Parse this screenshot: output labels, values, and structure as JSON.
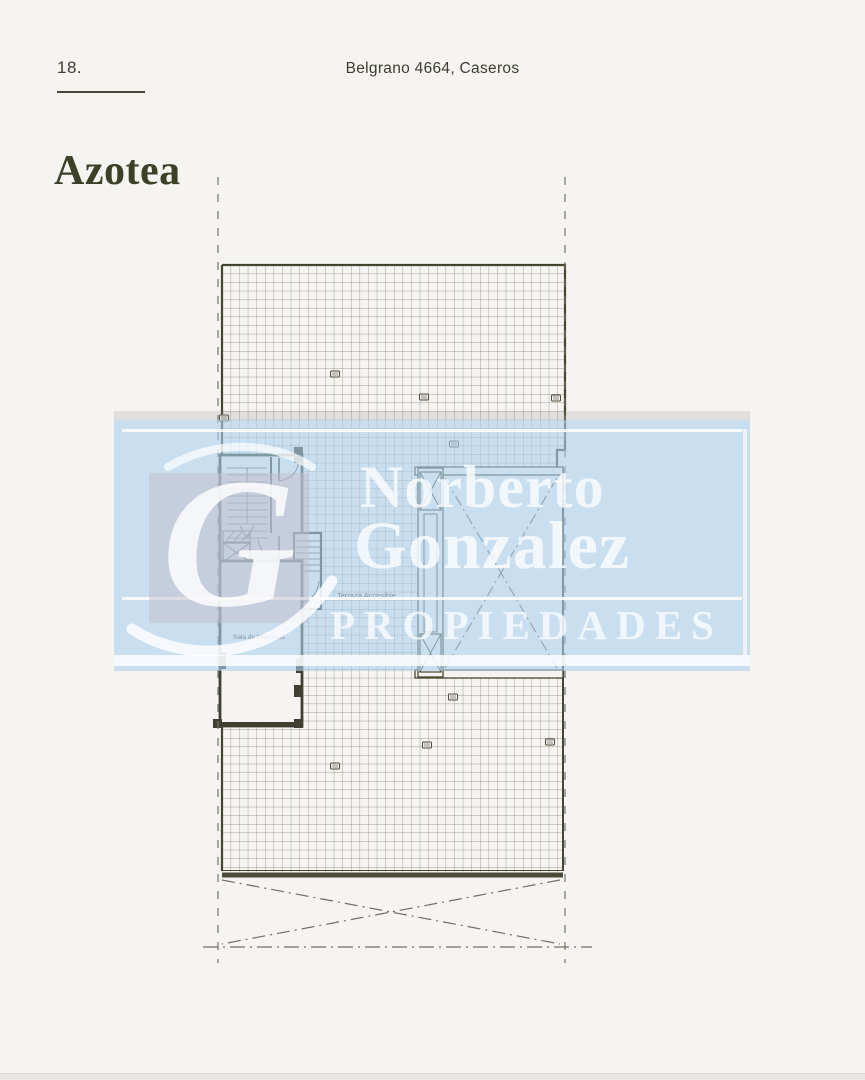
{
  "page": {
    "number": "18.",
    "header_title": "Belgrano 4664, Caseros",
    "section_title": "Azotea"
  },
  "plan": {
    "labels": {
      "terrace": "Terraza Accesible",
      "machine_room": "Sala de Maquinas"
    }
  },
  "watermark": {
    "monogram": "G",
    "line1": "Norberto",
    "line2": "Gonzalez",
    "line3": "PROPIEDADES"
  },
  "colors": {
    "page_background": "#f5f4f1",
    "title_accent": "#3a4126",
    "plan_line": "#45462f",
    "watermark_blue": "#d9e7f5",
    "watermark_text": "#fbfcff",
    "logo_square": "#d4cdd9"
  }
}
